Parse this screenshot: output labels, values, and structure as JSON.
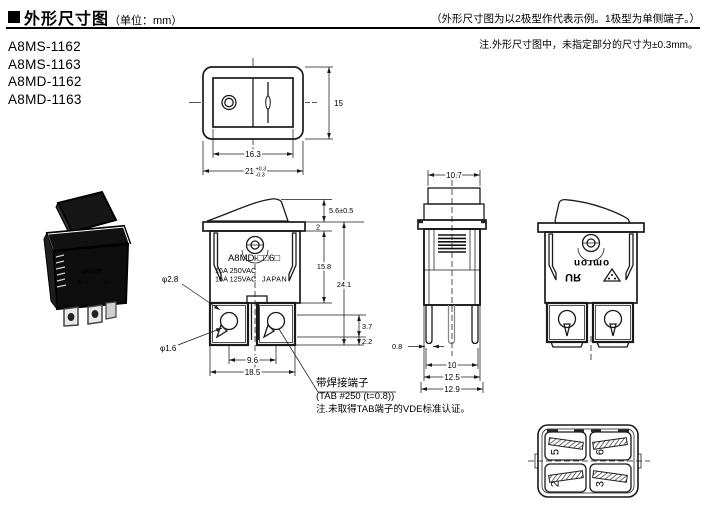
{
  "header": {
    "title": "外形尺寸图",
    "unit": "（单位：mm）",
    "right_note": "（外形尺寸图为以2极型作代表示例。1极型为单侧端子。）",
    "tol_note": "注.外形尺寸图中，未指定部分的尺寸为±0.3mm。"
  },
  "models": [
    "A8MS-1162",
    "A8MS-1163",
    "A8MD-1162",
    "A8MD-1163"
  ],
  "top_view": {
    "w_inner": "16.3",
    "w_outer": "21",
    "tol_plus": "+0.3",
    "tol_minus": "-0.3",
    "h": "15"
  },
  "front_view": {
    "model": "A8MD-□□6□",
    "rating1": "16A 250VAC",
    "rating2": "16A 125VAC",
    "origin": "JAPAN",
    "h_rocker": "5.6±0.5",
    "t_flange": "2",
    "h_body": "15.8",
    "h_total": "24.1",
    "d37": "3.7",
    "d22": "2.2",
    "pitch": "9.6",
    "span": "18.5",
    "hole_big": "φ2.8",
    "hole_small": "φ1.6"
  },
  "solder_note": {
    "l1": "带焊接端子",
    "l2": "(TAB #250 (t=0.8))",
    "l3": "注.未取得TAB端子的VDE标准认证。"
  },
  "side_view": {
    "w_top": "10.7",
    "t_term": "0.8",
    "w1": "10",
    "w2": "12.5",
    "w3": "12.9"
  },
  "back_view": {
    "logo": "omron",
    "ul": "ЯU"
  },
  "bottom_view": {
    "t1": "5",
    "t2": "6",
    "t3": "2",
    "t4": "3"
  }
}
